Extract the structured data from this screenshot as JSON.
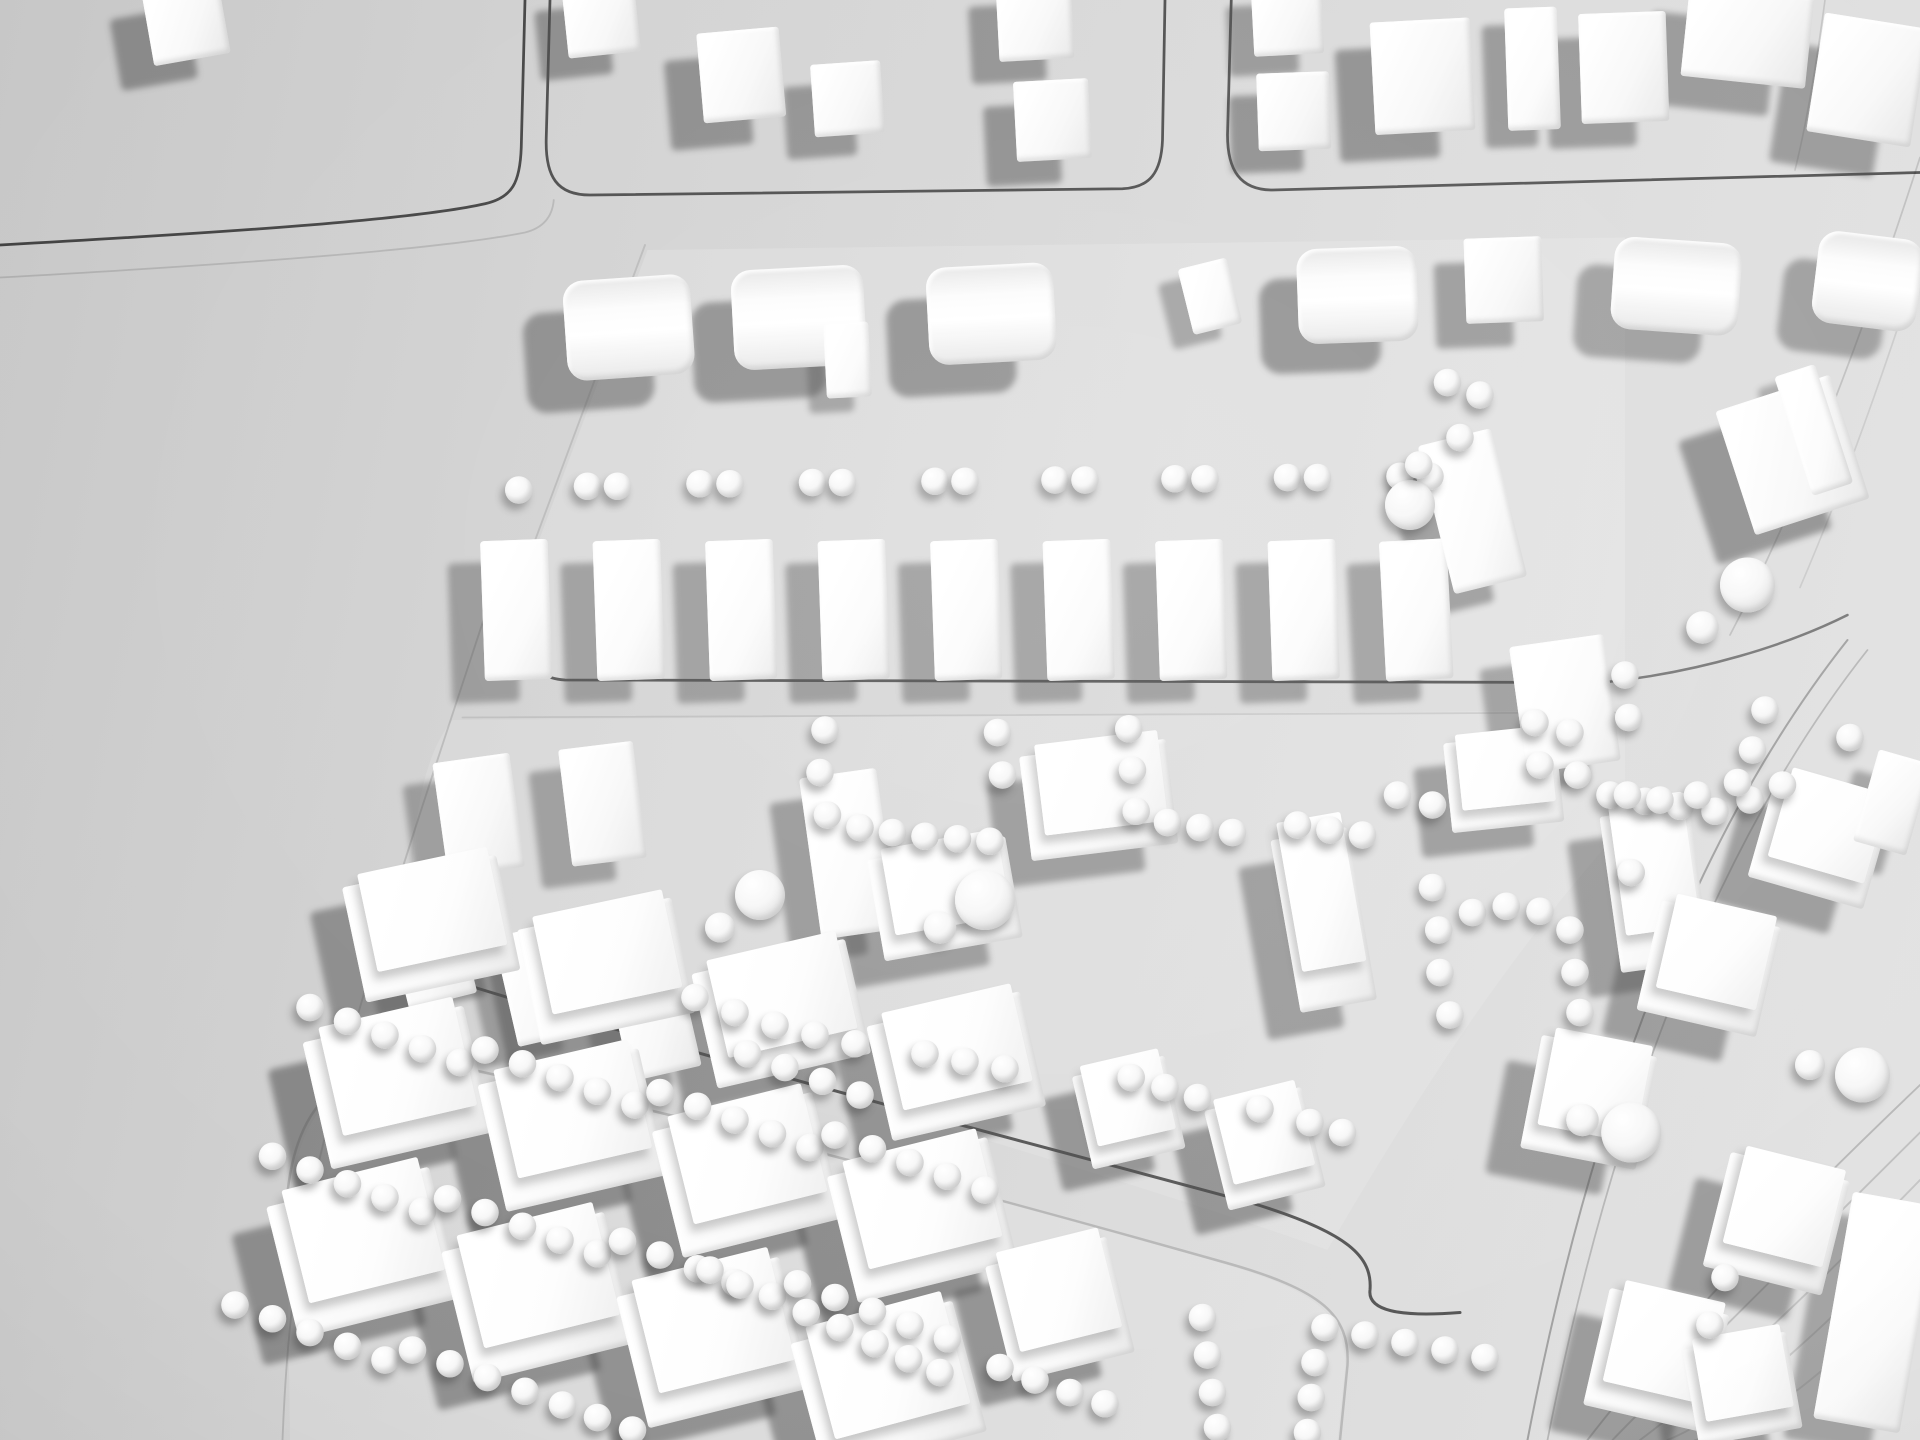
{
  "scene": {
    "description": "Black-and-white overhead photograph of a white architectural urban-massing study model: rectangular city blocks separated by incised street lines, white volumetric buildings (cubes, barrel-vault bars, slabs and podium blocks) and rows of small white spheres representing trees; terraced contour lines along the right edge; empty grey base board on the left.",
    "medium": "physical foam/plaster model, monochrome photo",
    "palette": {
      "background": "#d2d2d2",
      "building_highlight": "#ffffff",
      "building_mid": "#f2f2f2",
      "cast_shadow": "#4a4a4a",
      "street_line": "#141414"
    }
  },
  "canvas": {
    "width": 1536,
    "height": 1152,
    "scale": 1.25
  },
  "building_fields": [
    "x",
    "y",
    "w",
    "h",
    "rotation_deg",
    "type",
    "shadow_dx",
    "shadow_dy",
    "shadow_opacity"
  ],
  "plates": [
    {
      "name": "block-plate-band2",
      "d": "M 518 200 L 1300 190 L 1300 544 L 450 544 C 422 540 412 520 414 478 Z",
      "opacity": 0.16
    },
    {
      "name": "block-plate-band3",
      "d": "M 362 576 L 1300 568 L 1300 660 C 1200 770 1120 900 1062 1000 C 900 942 600 856 362 784 C 334 774 326 746 330 700 C 332 642 342 600 362 576 Z",
      "opacity": 0.13
    },
    {
      "name": "block-plate-band4",
      "d": "M 230 1010 C 228 906 254 862 332 848 C 540 890 790 956 982 1012 C 1056 1034 1078 1054 1076 1096 L 1070 1152 L 232 1152 Z",
      "opacity": 0.13
    }
  ],
  "streets": [
    {
      "name": "street-top-left-block-edge",
      "d": "M 0 196 C 180 186 330 176 388 163 C 410 158 416 146 417 118 L 420 0",
      "width": 2.2,
      "opacity": 0.75
    },
    {
      "name": "street-top-left-second-edge",
      "d": "M 0 222 C 180 212 350 200 420 186 C 436 182 442 172 443 160",
      "width": 1.4,
      "opacity": 0.14
    },
    {
      "name": "street-top-middle-block-outline",
      "d": "M 440 0 L 437 110 C 436 142 446 156 472 156 L 898 151 C 920 150 929 138 930 112 L 932 0",
      "width": 2.2,
      "opacity": 0.7
    },
    {
      "name": "street-top-right-block-outline",
      "d": "M 985 0 L 982 108 C 982 136 992 152 1018 152 L 1536 138",
      "width": 2.2,
      "opacity": 0.68
    },
    {
      "name": "street-band2-left-edge",
      "d": "M 516 196 L 414 470",
      "width": 1.5,
      "opacity": 0.12
    },
    {
      "name": "street-band2-bottom",
      "d": "M 412 462 C 410 516 420 542 452 544 L 1282 546",
      "width": 2.2,
      "opacity": 0.65
    },
    {
      "name": "street-band3-top-faint",
      "d": "M 370 574 L 1292 570",
      "width": 1.4,
      "opacity": 0.1
    },
    {
      "name": "street-band3-bottom",
      "d": "M 332 692 C 326 744 330 772 354 782 C 560 846 800 908 1000 962 C 1080 986 1098 1006 1096 1032 C 1094 1048 1118 1054 1168 1050",
      "width": 2.4,
      "opacity": 0.68
    },
    {
      "name": "street-band4-outline-faint",
      "d": "M 228 1006 C 226 902 252 860 330 846 C 520 884 760 948 980 1010 C 1058 1032 1080 1052 1078 1092 L 1072 1152",
      "width": 2,
      "opacity": 0.18
    },
    {
      "name": "street-left-diagonal-faint",
      "d": "M 392 480 C 340 640 270 840 240 1000 C 232 1048 228 1100 226 1152",
      "width": 1.5,
      "opacity": 0.15
    },
    {
      "name": "street-right-curve-dark",
      "d": "M 1282 546 C 1360 538 1430 516 1478 492",
      "width": 2,
      "opacity": 0.5
    },
    {
      "name": "street-right-diagonal-a",
      "d": "M 1478 512 C 1372 646 1280 850 1222 1152",
      "width": 1.6,
      "opacity": 0.3
    },
    {
      "name": "street-right-diagonal-b",
      "d": "M 1494 520 C 1388 654 1296 858 1238 1152",
      "width": 1.4,
      "opacity": 0.2
    },
    {
      "name": "slope-edge-top-right",
      "d": "M 1536 126 C 1480 300 1430 420 1384 508",
      "width": 1.4,
      "opacity": 0.15
    },
    {
      "name": "contour-top-right-1",
      "d": "M 1460 0 C 1452 60 1444 104 1436 136",
      "width": 1.3,
      "opacity": 0.12
    },
    {
      "name": "contour-top-right-2",
      "d": "M 1536 208 C 1500 320 1470 400 1440 470",
      "width": 1.3,
      "opacity": 0.1
    },
    {
      "name": "contour-bottom-right-1",
      "d": "M 1536 868 C 1448 952 1344 1056 1270 1152",
      "width": 1.5,
      "opacity": 0.2
    },
    {
      "name": "contour-bottom-right-2",
      "d": "M 1536 906 C 1456 986 1356 1084 1290 1152",
      "width": 1.5,
      "opacity": 0.16
    },
    {
      "name": "contour-bottom-right-3",
      "d": "M 1536 944 C 1466 1016 1372 1108 1312 1152",
      "width": 1.5,
      "opacity": 0.14
    },
    {
      "name": "contour-bottom-right-4",
      "d": "M 1536 982 C 1478 1044 1390 1130 1334 1152",
      "width": 1.5,
      "opacity": 0.12
    },
    {
      "name": "contour-bottom-right-5",
      "d": "M 1536 1020 C 1488 1072 1410 1148 1356 1152",
      "width": 1.5,
      "opacity": 0.1
    }
  ],
  "buildings": [
    [
      118,
      -10,
      62,
      58,
      -10,
      "cube",
      -26,
      20,
      0.5
    ],
    [
      452,
      -12,
      58,
      56,
      -6,
      "cube",
      -22,
      18,
      0.5
    ],
    [
      560,
      24,
      66,
      72,
      -5,
      "cube",
      -26,
      22,
      0.5
    ],
    [
      650,
      50,
      56,
      58,
      -4,
      "cube",
      -22,
      18,
      0.48
    ],
    [
      798,
      -14,
      60,
      62,
      -3,
      "cube",
      -22,
      18,
      0.48
    ],
    [
      812,
      64,
      60,
      64,
      -3,
      "cube",
      -24,
      20,
      0.5
    ],
    [
      1002,
      -12,
      56,
      56,
      -3,
      "cube",
      -20,
      16,
      0.45
    ],
    [
      1006,
      58,
      58,
      62,
      -2,
      "cube",
      -22,
      18,
      0.5
    ],
    [
      1098,
      16,
      80,
      90,
      -3,
      "cube",
      -28,
      22,
      0.5
    ],
    [
      1205,
      6,
      42,
      98,
      -2,
      "slab",
      -18,
      14,
      0.45
    ],
    [
      1264,
      10,
      70,
      88,
      -2,
      "cube",
      -26,
      20,
      0.45
    ],
    [
      1348,
      -8,
      100,
      74,
      6,
      "cube",
      -30,
      22,
      0.45
    ],
    [
      1452,
      16,
      84,
      96,
      9,
      "cube",
      -30,
      24,
      0.45
    ],
    [
      452,
      222,
      102,
      80,
      -4,
      "bar",
      -32,
      26,
      0.5
    ],
    [
      586,
      214,
      106,
      80,
      -3,
      "bar",
      -32,
      26,
      0.5
    ],
    [
      660,
      258,
      36,
      60,
      -3,
      "slab",
      -14,
      12,
      0.4
    ],
    [
      742,
      212,
      102,
      78,
      -3,
      "bar",
      -32,
      26,
      0.5
    ],
    [
      948,
      210,
      40,
      54,
      -14,
      "slab",
      -16,
      12,
      0.4
    ],
    [
      1038,
      198,
      96,
      76,
      -2,
      "bar",
      -30,
      24,
      0.5
    ],
    [
      1172,
      190,
      62,
      68,
      -2,
      "cube",
      -24,
      20,
      0.45
    ],
    [
      1290,
      192,
      102,
      74,
      4,
      "bar",
      -30,
      22,
      0.42
    ],
    [
      1452,
      188,
      84,
      74,
      7,
      "bar",
      -28,
      22,
      0.42
    ],
    [
      386,
      432,
      54,
      112,
      -2,
      "slab",
      -26,
      18,
      0.42
    ],
    [
      476,
      432,
      54,
      112,
      -2,
      "slab",
      -26,
      18,
      0.42
    ],
    [
      566,
      432,
      54,
      112,
      -2,
      "slab",
      -26,
      18,
      0.42
    ],
    [
      656,
      432,
      54,
      112,
      -2,
      "slab",
      -26,
      18,
      0.42
    ],
    [
      746,
      432,
      54,
      112,
      -2,
      "slab",
      -26,
      18,
      0.42
    ],
    [
      836,
      432,
      54,
      112,
      -2,
      "slab",
      -26,
      18,
      0.42
    ],
    [
      926,
      432,
      54,
      112,
      -2,
      "slab",
      -26,
      18,
      0.42
    ],
    [
      1016,
      432,
      54,
      112,
      -2,
      "slab",
      -26,
      18,
      0.42
    ],
    [
      1106,
      432,
      54,
      112,
      -3,
      "slab",
      -26,
      18,
      0.42
    ],
    [
      1148,
      348,
      60,
      122,
      -14,
      "slab",
      -26,
      20,
      0.45
    ],
    [
      352,
      606,
      62,
      92,
      -8,
      "cube",
      -24,
      18,
      0.42
    ],
    [
      452,
      596,
      60,
      94,
      -7,
      "cube",
      -24,
      18,
      0.42
    ],
    [
      316,
      714,
      56,
      88,
      -14,
      "cube",
      -22,
      16,
      0.42
    ],
    [
      404,
      742,
      60,
      90,
      -13,
      "cube",
      -22,
      16,
      0.42
    ],
    [
      494,
      770,
      58,
      90,
      -13,
      "cube",
      -22,
      16,
      0.42
    ],
    [
      648,
      618,
      62,
      130,
      -8,
      "slab",
      -24,
      20,
      0.45
    ],
    [
      820,
      598,
      118,
      84,
      -7,
      "podium",
      -26,
      22,
      0.45
    ],
    [
      1028,
      666,
      62,
      140,
      -10,
      "podium",
      -26,
      22,
      0.45
    ],
    [
      700,
      678,
      112,
      82,
      -10,
      "podium",
      -26,
      22,
      0.45
    ],
    [
      1158,
      590,
      90,
      72,
      -6,
      "podium",
      -24,
      20,
      0.45
    ],
    [
      1288,
      648,
      72,
      126,
      -8,
      "podium",
      -26,
      20,
      0.45
    ],
    [
      865,
      852,
      76,
      76,
      -13,
      "podium",
      -24,
      18,
      0.5
    ],
    [
      972,
      878,
      80,
      82,
      -14,
      "podium",
      -26,
      20,
      0.5
    ],
    [
      282,
      696,
      126,
      94,
      -12,
      "podium",
      -26,
      20,
      0.5
    ],
    [
      422,
      730,
      126,
      94,
      -12,
      "podium",
      -26,
      20,
      0.5
    ],
    [
      562,
      764,
      126,
      94,
      -13,
      "podium",
      -26,
      20,
      0.5
    ],
    [
      702,
      806,
      126,
      94,
      -13,
      "podium",
      -26,
      20,
      0.5
    ],
    [
      252,
      818,
      132,
      104,
      -13,
      "podium",
      -28,
      22,
      0.55
    ],
    [
      392,
      852,
      132,
      104,
      -13,
      "podium",
      -28,
      22,
      0.55
    ],
    [
      532,
      888,
      132,
      104,
      -14,
      "podium",
      -28,
      22,
      0.55
    ],
    [
      672,
      924,
      132,
      104,
      -14,
      "podium",
      -28,
      22,
      0.55
    ],
    [
      224,
      948,
      134,
      108,
      -14,
      "podium",
      -28,
      22,
      0.5
    ],
    [
      364,
      984,
      134,
      108,
      -14,
      "podium",
      -28,
      22,
      0.5
    ],
    [
      504,
      1020,
      134,
      108,
      -14,
      "podium",
      -28,
      22,
      0.5
    ],
    [
      644,
      1056,
      134,
      108,
      -15,
      "podium",
      -28,
      22,
      0.5
    ],
    [
      798,
      1000,
      100,
      95,
      -14,
      "podium",
      -26,
      20,
      0.5
    ],
    [
      1386,
      312,
      96,
      104,
      -18,
      "cube",
      -30,
      24,
      0.5
    ],
    [
      1434,
      294,
      34,
      100,
      -18,
      "slab",
      -14,
      10,
      0.35
    ],
    [
      1214,
      512,
      76,
      102,
      -8,
      "slab",
      -24,
      18,
      0.42
    ],
    [
      1408,
      630,
      96,
      86,
      16,
      "podium",
      -28,
      20,
      0.45
    ],
    [
      1318,
      730,
      98,
      90,
      13,
      "podium",
      -28,
      20,
      0.45
    ],
    [
      1224,
      836,
      94,
      92,
      11,
      "podium",
      -28,
      20,
      0.45
    ],
    [
      1372,
      932,
      98,
      94,
      14,
      "podium",
      -28,
      20,
      0.45
    ],
    [
      1276,
      1040,
      98,
      96,
      13,
      "podium",
      -28,
      20,
      0.45
    ],
    [
      1466,
      958,
      70,
      184,
      10,
      "slab",
      -24,
      16,
      0.4
    ],
    [
      1492,
      604,
      44,
      76,
      16,
      "cube",
      -20,
      16,
      0.4
    ],
    [
      1352,
      1072,
      84,
      78,
      -10,
      "podium",
      -26,
      18,
      0.45
    ]
  ],
  "tree_default_radius": 11,
  "trees": [
    [
      415,
      392
    ],
    [
      470,
      389
    ],
    [
      494,
      389
    ],
    [
      560,
      387
    ],
    [
      584,
      387
    ],
    [
      650,
      386
    ],
    [
      674,
      386
    ],
    [
      748,
      385
    ],
    [
      772,
      385
    ],
    [
      844,
      384
    ],
    [
      868,
      384
    ],
    [
      940,
      383
    ],
    [
      964,
      383
    ],
    [
      1030,
      382
    ],
    [
      1054,
      382
    ],
    [
      1120,
      381
    ],
    [
      1144,
      381
    ],
    [
      1158,
      306
    ],
    [
      1184,
      316
    ],
    [
      1168,
      350
    ],
    [
      660,
      584
    ],
    [
      656,
      618
    ],
    [
      662,
      652
    ],
    [
      688,
      662
    ],
    [
      714,
      666
    ],
    [
      740,
      669
    ],
    [
      766,
      671
    ],
    [
      792,
      673
    ],
    [
      798,
      586
    ],
    [
      802,
      620
    ],
    [
      903,
      583
    ],
    [
      906,
      616
    ],
    [
      909,
      649
    ],
    [
      934,
      658
    ],
    [
      960,
      662
    ],
    [
      986,
      666
    ],
    [
      1038,
      660
    ],
    [
      1064,
      664
    ],
    [
      1090,
      668
    ],
    [
      1228,
      578
    ],
    [
      1232,
      612
    ],
    [
      1118,
      636
    ],
    [
      1146,
      644
    ],
    [
      1256,
      586
    ],
    [
      1262,
      620
    ],
    [
      1288,
      636
    ],
    [
      1316,
      641
    ],
    [
      1344,
      645
    ],
    [
      1372,
      649
    ],
    [
      1400,
      640
    ],
    [
      1426,
      628
    ],
    [
      1146,
      710
    ],
    [
      1151,
      744
    ],
    [
      1178,
      730
    ],
    [
      1205,
      725
    ],
    [
      1232,
      729
    ],
    [
      1256,
      744
    ],
    [
      1260,
      778
    ],
    [
      1264,
      810
    ],
    [
      1152,
      778
    ],
    [
      1160,
      812
    ],
    [
      556,
      798
    ],
    [
      588,
      810
    ],
    [
      620,
      820
    ],
    [
      652,
      828
    ],
    [
      684,
      835
    ],
    [
      740,
      843
    ],
    [
      772,
      849
    ],
    [
      804,
      855
    ],
    [
      905,
      862
    ],
    [
      932,
      870
    ],
    [
      958,
      878
    ],
    [
      1008,
      887
    ],
    [
      1048,
      898
    ],
    [
      1074,
      906
    ],
    [
      598,
      843
    ],
    [
      628,
      854
    ],
    [
      658,
      865
    ],
    [
      688,
      876
    ],
    [
      248,
      806
    ],
    [
      278,
      817
    ],
    [
      308,
      828
    ],
    [
      338,
      839
    ],
    [
      368,
      850
    ],
    [
      388,
      840
    ],
    [
      418,
      851
    ],
    [
      448,
      862
    ],
    [
      478,
      873
    ],
    [
      508,
      884
    ],
    [
      528,
      874
    ],
    [
      558,
      885
    ],
    [
      588,
      896
    ],
    [
      618,
      907
    ],
    [
      648,
      918
    ],
    [
      668,
      908
    ],
    [
      698,
      919
    ],
    [
      728,
      930
    ],
    [
      758,
      941
    ],
    [
      788,
      952
    ],
    [
      218,
      925
    ],
    [
      248,
      936
    ],
    [
      278,
      947
    ],
    [
      308,
      958
    ],
    [
      338,
      969
    ],
    [
      358,
      959
    ],
    [
      388,
      970
    ],
    [
      418,
      981
    ],
    [
      448,
      992
    ],
    [
      478,
      1003
    ],
    [
      498,
      993
    ],
    [
      528,
      1004
    ],
    [
      558,
      1015
    ],
    [
      588,
      1026
    ],
    [
      618,
      1037
    ],
    [
      638,
      1027
    ],
    [
      668,
      1038
    ],
    [
      698,
      1049
    ],
    [
      728,
      1060
    ],
    [
      758,
      1071
    ],
    [
      188,
      1044
    ],
    [
      218,
      1055
    ],
    [
      248,
      1066
    ],
    [
      278,
      1077
    ],
    [
      308,
      1088
    ],
    [
      330,
      1080
    ],
    [
      360,
      1091
    ],
    [
      390,
      1102
    ],
    [
      420,
      1113
    ],
    [
      450,
      1124
    ],
    [
      478,
      1134
    ],
    [
      506,
      1144
    ],
    [
      568,
      1016
    ],
    [
      592,
      1028
    ],
    [
      645,
      1050
    ],
    [
      672,
      1062
    ],
    [
      700,
      1075
    ],
    [
      727,
      1087
    ],
    [
      752,
      1098
    ],
    [
      800,
      1094
    ],
    [
      828,
      1104
    ],
    [
      856,
      1114
    ],
    [
      884,
      1123
    ],
    [
      962,
      1054
    ],
    [
      966,
      1084
    ],
    [
      970,
      1114
    ],
    [
      974,
      1142
    ],
    [
      1060,
      1062
    ],
    [
      1092,
      1068
    ],
    [
      1124,
      1074
    ],
    [
      1156,
      1080
    ],
    [
      1188,
      1086
    ],
    [
      1052,
      1090
    ],
    [
      1049,
      1118
    ],
    [
      1046,
      1146
    ],
    [
      1412,
      568
    ],
    [
      1402,
      600
    ],
    [
      1390,
      626
    ],
    [
      1358,
      636
    ],
    [
      1328,
      640
    ],
    [
      1302,
      636
    ],
    [
      1480,
      590
    ],
    [
      1305,
      698
    ],
    [
      1300,
      540
    ],
    [
      1303,
      574
    ],
    [
      1380,
      1022
    ],
    [
      1368,
      1060
    ],
    [
      608,
      716,
      20
    ],
    [
      788,
      720,
      24
    ],
    [
      1128,
      404,
      20
    ],
    [
      1305,
      906,
      24
    ],
    [
      1490,
      860,
      22
    ],
    [
      1398,
      468,
      22
    ],
    [
      576,
      742,
      12
    ],
    [
      752,
      742,
      13
    ],
    [
      1266,
      896,
      13
    ],
    [
      1448,
      852,
      12
    ],
    [
      1362,
      502,
      13
    ],
    [
      1135,
      372,
      11
    ]
  ]
}
